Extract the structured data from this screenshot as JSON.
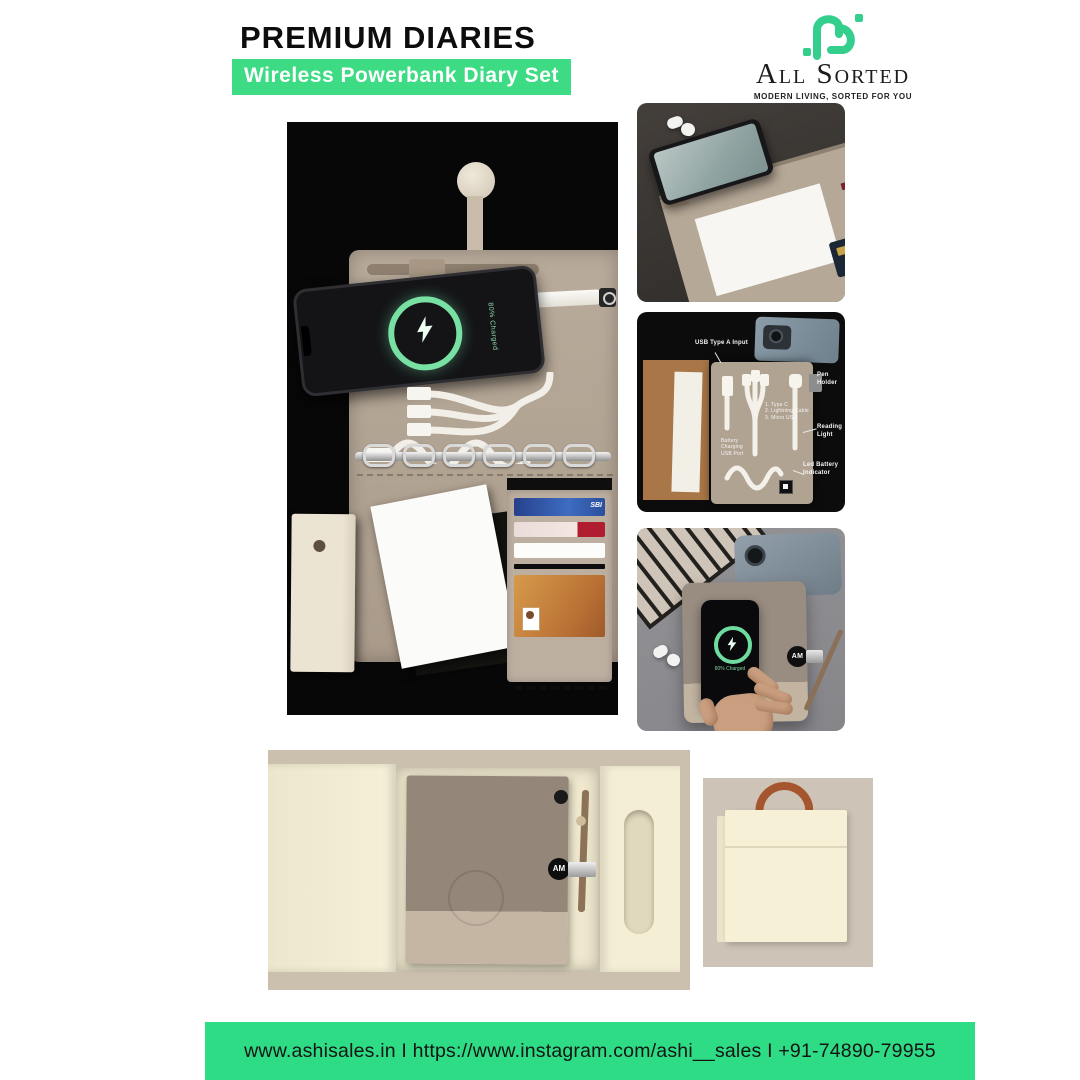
{
  "header": {
    "title": "PREMIUM DIARIES",
    "subtitle": "Wireless Powerbank Diary Set"
  },
  "brand": {
    "name": "All Sorted",
    "tagline": "MODERN LIVING, SORTED FOR YOU",
    "logo_icon": "all-sorted-knot-icon",
    "logo_color": "#35cf8d"
  },
  "hero": {
    "phone_status": "80% Charged",
    "card_label": "SBI",
    "bolt_icon": "lightning-bolt"
  },
  "thumbnails": {
    "diagram": {
      "labels": {
        "usb": "USB Type A Input",
        "pen": "Pen Holder",
        "light": "Reading Light",
        "battery": "Led Battery Indicator",
        "cable_note": "1. Type C\n2. Lightning Cable\n3. Micro USB",
        "charge_port": "Battery Charging\nUSB Port"
      }
    },
    "charging": {
      "badge": "AM"
    }
  },
  "giftbox": {
    "badge": "AM"
  },
  "footer": {
    "contact": "www.ashisales.in I https://www.instagram.com/ashi__sales I +91-74890-79955"
  },
  "theme": {
    "accent_green": "#2edc85",
    "label_green": "#3ddc84",
    "diary_tan": "#b1a392",
    "cream": "#f4eed5"
  }
}
